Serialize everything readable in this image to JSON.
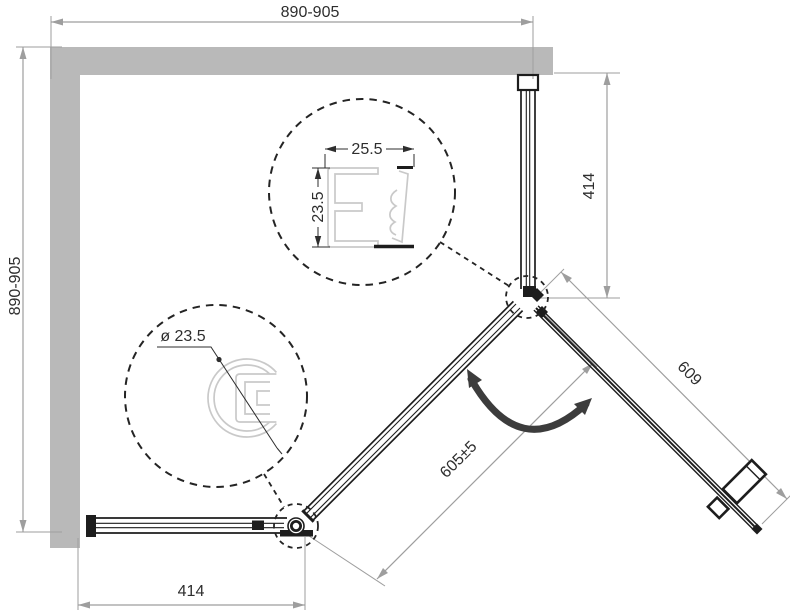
{
  "title": "shower-enclosure-technical-drawing",
  "dimensions": {
    "top_width": "890-905",
    "left_depth": "890-905",
    "right_fixed_panel": "414",
    "bottom_fixed_panel": "414",
    "door_length": "609",
    "entry_opening": "605±5"
  },
  "details": {
    "wall_profile_width": "25.5",
    "wall_profile_depth": "23.5",
    "corner_post_diameter": "ø 23.5"
  },
  "colors": {
    "wall": "#b9b9b9",
    "dimension_line": "#9e9e9e",
    "drawing_line": "#1d1d1d",
    "profile_light": "#c9c9c9",
    "swing_arrow": "#3c3c3c",
    "background": "#ffffff"
  }
}
